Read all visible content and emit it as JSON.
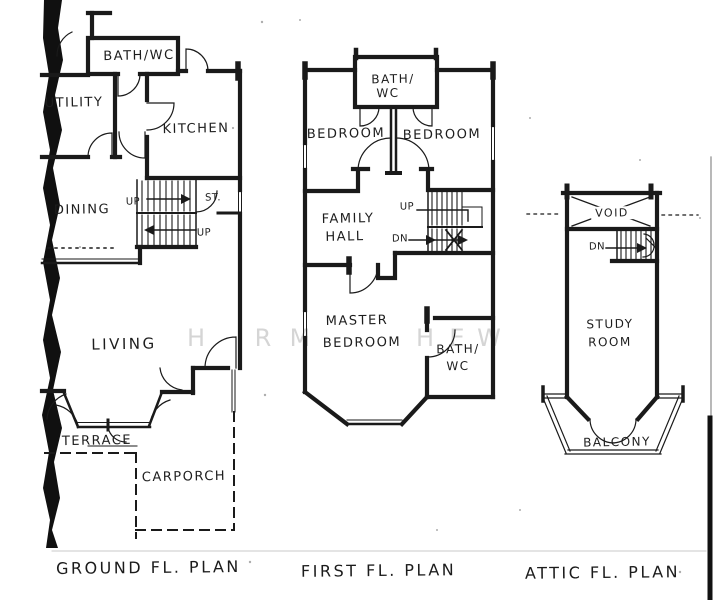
{
  "document": {
    "watermark_letters": [
      "H",
      "R",
      "M",
      "H",
      "E",
      "W"
    ],
    "plans": {
      "ground": {
        "caption": "GROUND FL. PLAN",
        "labels": {
          "bath_wc": "BATH/WC",
          "utility": "UTILITY",
          "kitchen": "KITCHEN",
          "dining": "DINING",
          "living": "LIVING",
          "terrace": "TERRACE",
          "carporch": "CARPORCH",
          "stair_up_upper": "UP",
          "stair_up_lower": "UP",
          "store": "ST."
        }
      },
      "first": {
        "caption": "FIRST FL. PLAN",
        "labels": {
          "bath_top_1": "BATH/",
          "bath_top_2": "WC",
          "bedroom_left": "BEDROOM",
          "bedroom_right": "BEDROOM",
          "family_1": "FAMILY",
          "family_2": "HALL",
          "master_1": "MASTER",
          "master_2": "BEDROOM",
          "bath_bottom_1": "BATH/",
          "bath_bottom_2": "WC",
          "stair_up": "UP",
          "stair_dn": "DN"
        }
      },
      "attic": {
        "caption": "ATTIC FL. PLAN",
        "labels": {
          "void": "VOID",
          "study_1": "STUDY",
          "study_2": "ROOM",
          "balcony": "BALCONY",
          "stair_dn": "DN"
        }
      }
    },
    "colors": {
      "ink": "#1a1a1a",
      "paper": "#ffffff",
      "watermark": "#d5d5d5"
    }
  }
}
